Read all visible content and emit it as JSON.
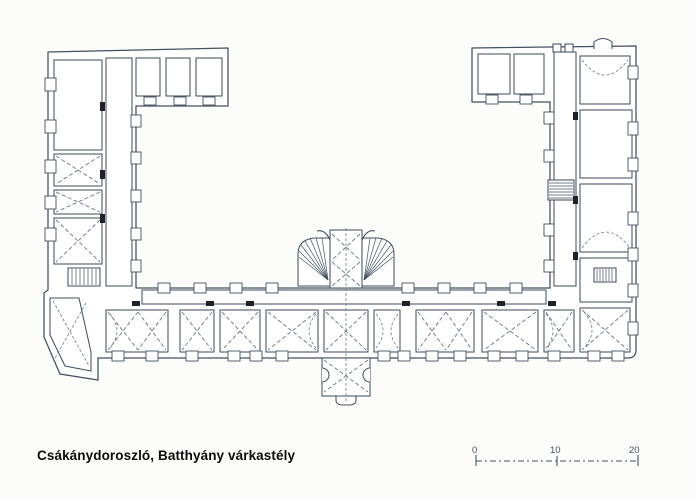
{
  "theme": {
    "paper": "#fcfcfb",
    "ink": "#454f63",
    "dash": "#6e7990",
    "marker": "#20222a",
    "cap": "#0b0b0b"
  },
  "caption": {
    "text": "Csákánydoroszló, Batthyány várkastély"
  },
  "scale_bar": {
    "labels": [
      "0",
      "10",
      "20"
    ]
  }
}
